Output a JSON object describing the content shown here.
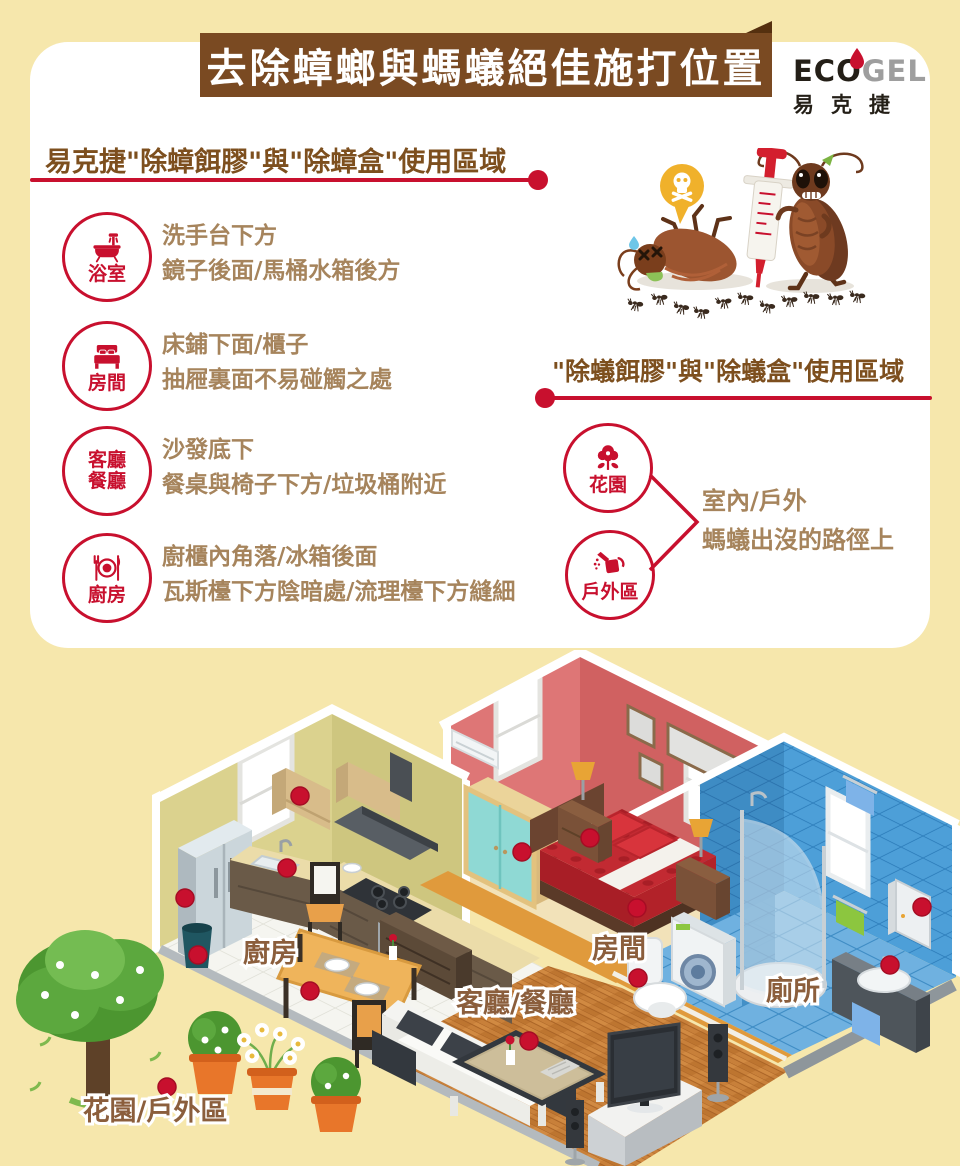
{
  "colors": {
    "background": "#F6E7AC",
    "card": "#FFFFFF",
    "banner_brown": "#7A4A22",
    "accent_red": "#C8102E",
    "header_brown": "#7D4F1E",
    "tip_text_brown": "#A6845C",
    "house_label_brown": "#8B5E3C",
    "logo_gray": "#9E9E9E"
  },
  "banner": {
    "title": "去除蟑螂與螞蟻絕佳施打位置"
  },
  "logo": {
    "en_left": "EC",
    "en_o": "O",
    "en_right": "GEL",
    "zh": "易克捷"
  },
  "roach_section": {
    "header": "易克捷\"除蟑餌膠\"與\"除蟑盒\"使用區域",
    "items": [
      {
        "icon": "bathtub-icon",
        "room": [
          "浴室"
        ],
        "lines": [
          "洗手台下方",
          "鏡子後面/馬桶水箱後方"
        ]
      },
      {
        "icon": "bed-icon",
        "room": [
          "房間"
        ],
        "lines": [
          "床鋪下面/櫃子",
          "抽屜裏面不易碰觸之處"
        ]
      },
      {
        "icon": null,
        "room": [
          "客廳",
          "餐廳"
        ],
        "lines": [
          "沙發底下",
          "餐桌與椅子下方/垃圾桶附近"
        ]
      },
      {
        "icon": "cutlery-icon",
        "room": [
          "廚房"
        ],
        "lines": [
          "廚櫃內角落/冰箱後面",
          "瓦斯檯下方陰暗處/流理檯下方縫細"
        ]
      }
    ]
  },
  "ant_section": {
    "header": "\"除蟻餌膠\"與\"除蟻盒\"使用區域",
    "items": [
      {
        "icon": "flower-icon",
        "room": "花園"
      },
      {
        "icon": "watering-can-icon",
        "room": "戶外區"
      }
    ],
    "note_lines": [
      "室內/戶外",
      "螞蟻出沒的路徑上"
    ]
  },
  "house": {
    "labels": {
      "kitchen": "廚房",
      "bedroom": "房間",
      "living_dining": "客廳/餐廳",
      "toilet": "廁所",
      "garden_outdoor": "花園/戶外區"
    },
    "gel_spots": [
      [
        300,
        796
      ],
      [
        287,
        868
      ],
      [
        185,
        898
      ],
      [
        198,
        955
      ],
      [
        310,
        991
      ],
      [
        522,
        852
      ],
      [
        590,
        838
      ],
      [
        637,
        908
      ],
      [
        529,
        1041
      ],
      [
        638,
        978
      ],
      [
        890,
        965
      ],
      [
        922,
        907
      ],
      [
        167,
        1087
      ]
    ]
  }
}
